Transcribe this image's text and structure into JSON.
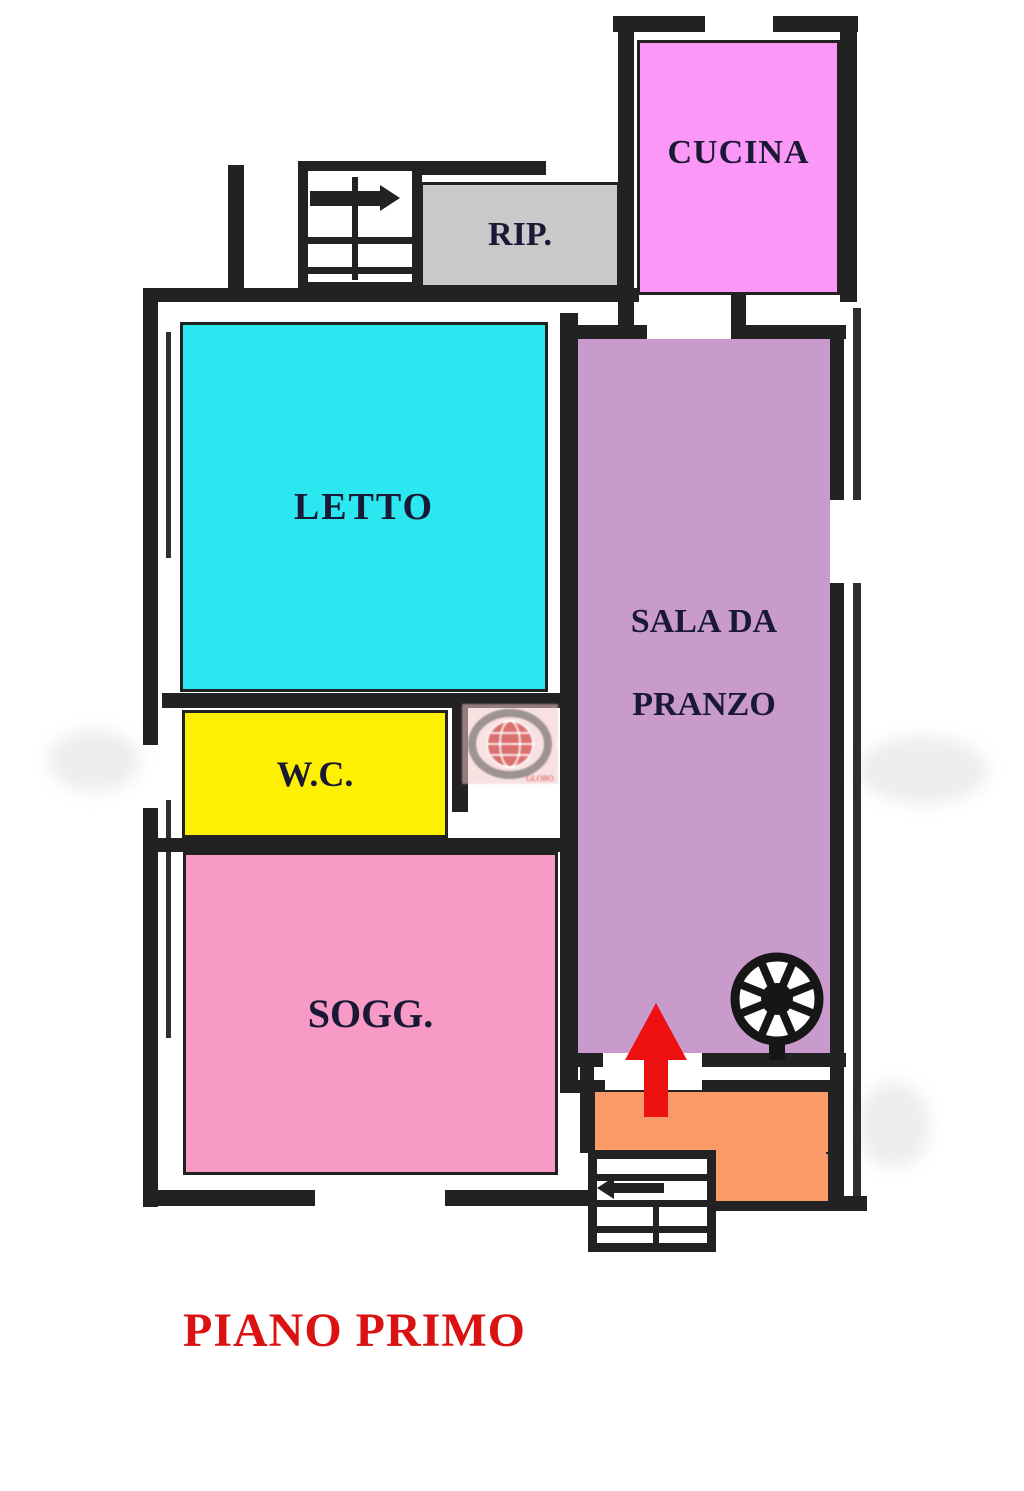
{
  "floor_plan": {
    "title": "PIANO PRIMO",
    "title_color": "#da1212",
    "wall_color": "#222222",
    "label_color": "#191935",
    "rooms": {
      "cucina": {
        "label": "CUCINA",
        "color": "#fb97f7"
      },
      "rip": {
        "label": "RIP.",
        "color": "#c9c9c9"
      },
      "letto": {
        "label": "LETTO",
        "color": "#2be7f0"
      },
      "sala": {
        "label_line1": "SALA DA",
        "label_line2": "PRANZO",
        "color": "#c99bcc"
      },
      "wc": {
        "label": "W.C.",
        "color": "#fdf101"
      },
      "sogg": {
        "label": "SOGG.",
        "color": "#f89ac6"
      },
      "ingresso": {
        "label": "",
        "color": "#f99a68"
      }
    },
    "icons": {
      "up_arrow": {
        "name": "up-arrow",
        "color": "#ee1111"
      },
      "fan": {
        "name": "fan-wheel"
      },
      "stairs_top": {
        "name": "staircase-with-direction-arrow"
      },
      "stairs_bottom": {
        "name": "staircase-with-direction-arrow"
      }
    },
    "watermark": {
      "text": "GLOBO"
    }
  }
}
